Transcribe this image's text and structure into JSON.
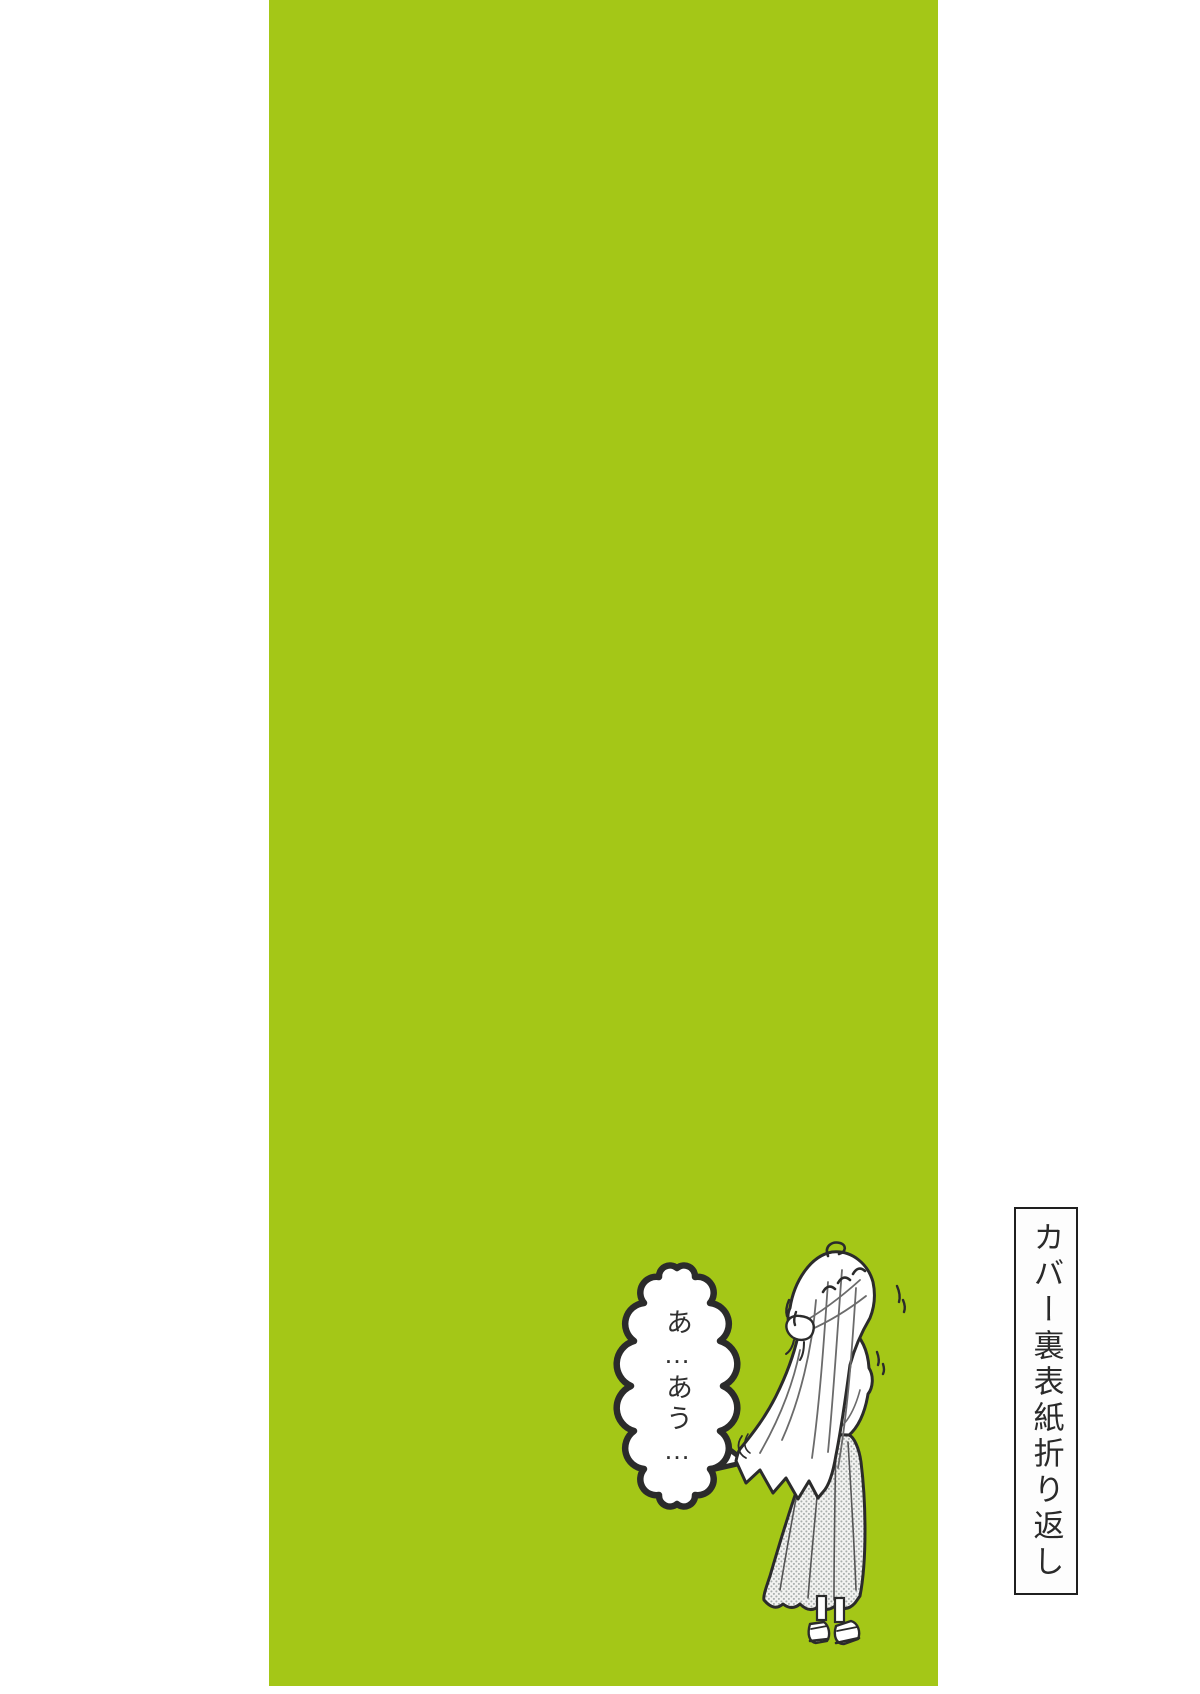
{
  "colors": {
    "panel_green": "#a4c717",
    "line": "#2b2b2b",
    "paper": "#ffffff",
    "label_ink": "#2a2a2a"
  },
  "speech_bubble": {
    "text": "あ…あう…"
  },
  "side_label": {
    "text": "カバー裏表紙折り返し"
  }
}
